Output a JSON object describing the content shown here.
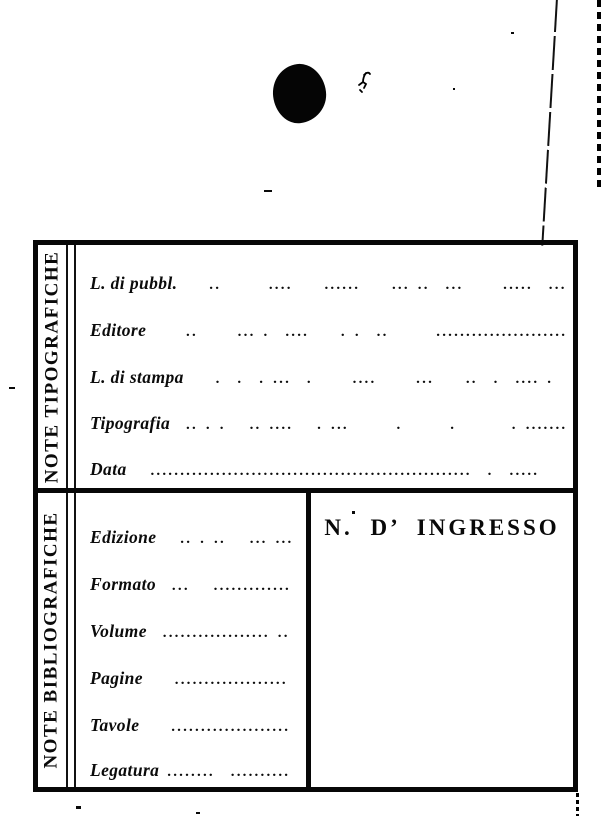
{
  "page": {
    "background": "#ffffff",
    "ink": "#000000"
  },
  "sections": [
    {
      "side_label": "NOTE TIPOGRAFICHE",
      "rows": [
        {
          "label": "L. di pubbl.",
          "dots": "    ..      ....    ......    ... ..  ...     .....  ..."
        },
        {
          "label": "Editore",
          "dots": "     ..     ... .  ....    . .  ..      ........................"
        },
        {
          "label": "L. di stampa",
          "dots": "    .  .  . ...  .     ....     ...    ..  .  .... .  . .."
        },
        {
          "label": "Tipografia",
          "dots": "  .. . .   .. ....   . ...      .      .       . ..........."
        },
        {
          "label": "Data",
          "dots": "   ......................................................  .  ....."
        }
      ]
    },
    {
      "side_label": "NOTE BIBLIOGRAFICHE",
      "ingresso_label": "N.  D’ INGRESSO",
      "rows": [
        {
          "label": "Edizione",
          "dots": "   .. . ..   ... ......"
        },
        {
          "label": "Formato",
          "dots": "  ...   .............."
        },
        {
          "label": "Volume",
          "dots": "  .................. .."
        },
        {
          "label": "Pagine",
          "dots": "    ..................."
        },
        {
          "label": "Tavole",
          "dots": "    ...................."
        },
        {
          "label": "Legatura",
          "dots": " ........  .........."
        }
      ]
    }
  ]
}
